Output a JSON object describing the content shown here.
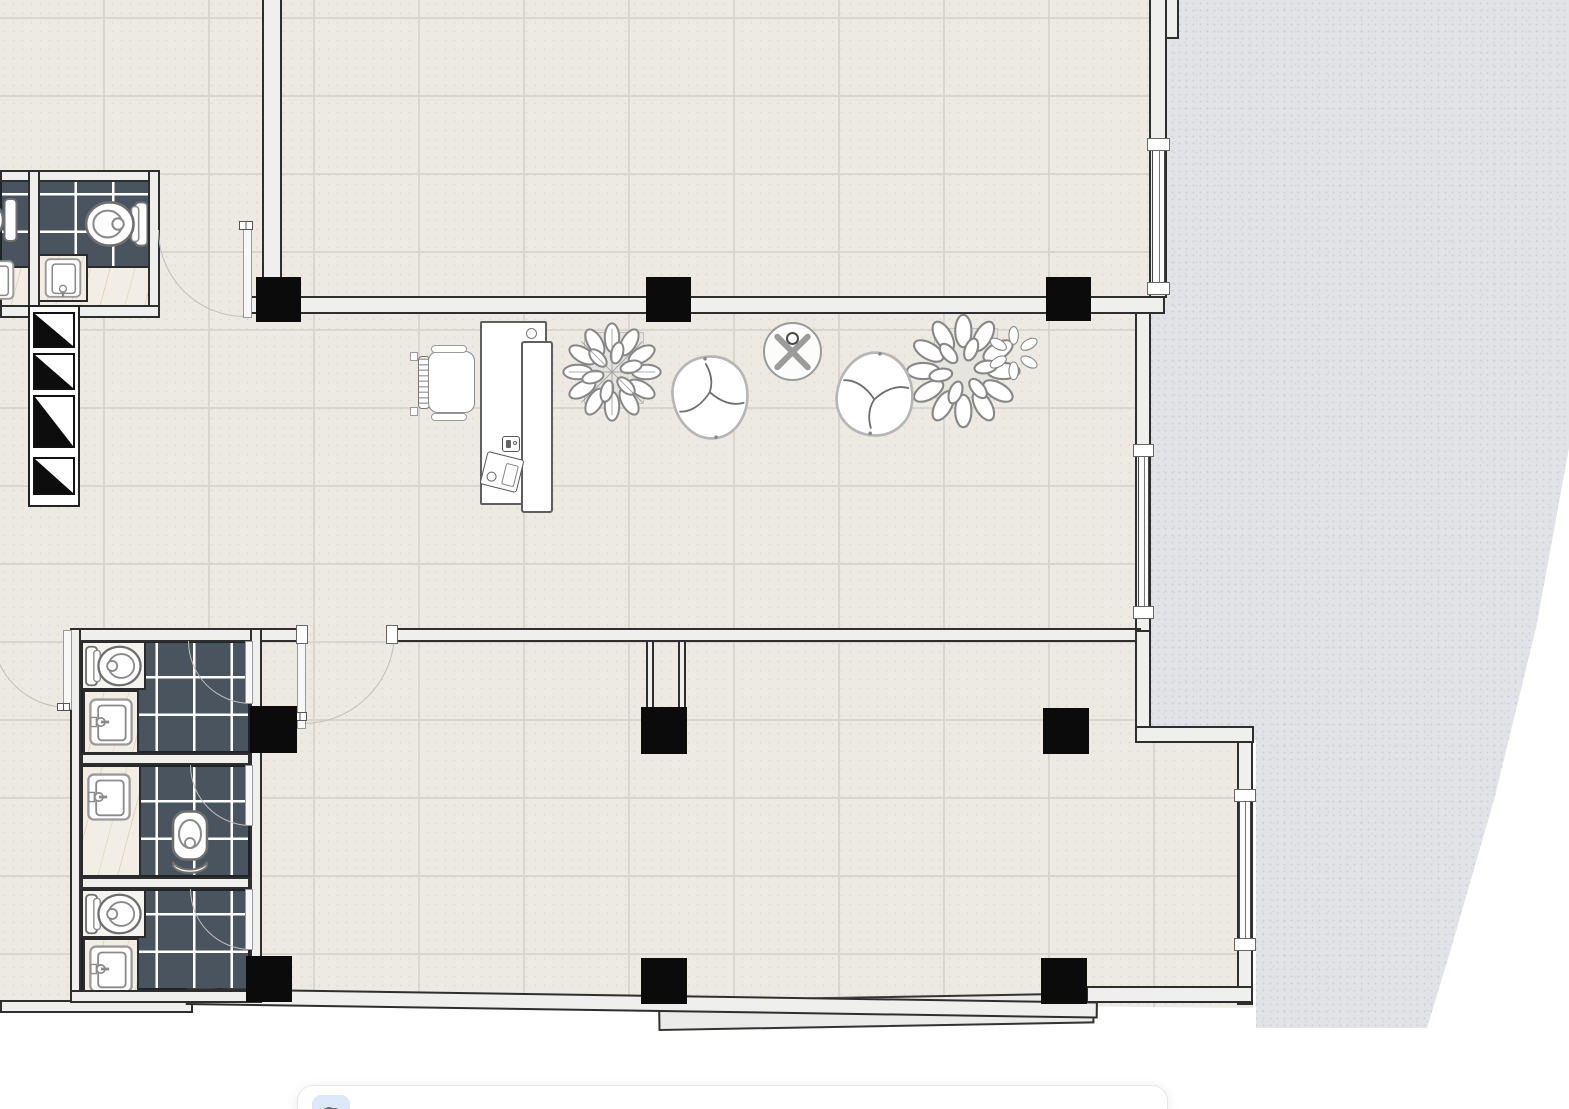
{
  "canvas": {
    "background": "#ffffff"
  },
  "palette": {
    "floor_tile": "#edeae3",
    "floor_grout": "#d9d6ce",
    "exterior_ground": "#e2e3e6",
    "wall_fill": "#efefed",
    "wall_line": "#2e2e2e",
    "column": "#0b0b0b",
    "bath_tile": "#4a545e",
    "bath_tile_grout": "#ffffff",
    "marble": "#f3eee5",
    "fixture_stroke": "#8a8a8a",
    "furniture_stroke": "#9c9c9c",
    "door_arc": "#bfbfbf",
    "toolbar_bg": "#ffffff",
    "toolbar_border": "#e7e7e7",
    "tool_fg": "#5f6368",
    "tool_selected_bg": "#dde9fb",
    "tool_selected_fg": "#2f6fe4"
  },
  "floorplan": {
    "rooms": [
      {
        "id": "upper-hall"
      },
      {
        "id": "lobby"
      },
      {
        "id": "lower-hall"
      },
      {
        "id": "wc-upper"
      },
      {
        "id": "wc-stall-1"
      },
      {
        "id": "wc-stall-2"
      },
      {
        "id": "wc-stall-3"
      },
      {
        "id": "stair-shaft"
      }
    ],
    "structure": {
      "columns": 9,
      "windows": 3,
      "doors": 6,
      "shaft_cells": 4
    },
    "fixtures": [
      {
        "type": "toilet",
        "room": "wc-upper"
      },
      {
        "type": "sink",
        "room": "wc-upper"
      },
      {
        "type": "toilet",
        "room": "wc-stall-1"
      },
      {
        "type": "sink",
        "room": "wc-stall-1"
      },
      {
        "type": "toilet",
        "room": "wc-stall-2"
      },
      {
        "type": "sink",
        "room": "wc-stall-2"
      },
      {
        "type": "toilet",
        "room": "wc-stall-3"
      },
      {
        "type": "sink",
        "room": "wc-stall-3"
      }
    ],
    "furniture": [
      "reception-desk",
      "office-chair",
      "lounge-chair-left",
      "lounge-chair-right",
      "round-side-table",
      "plant-small",
      "plant-large"
    ]
  },
  "toolbar": {
    "caret": "▾",
    "tools": [
      {
        "id": "select",
        "icon": "▶",
        "selected": true
      },
      {
        "id": "wall",
        "icon": "✎",
        "selected": false
      },
      {
        "id": "room",
        "icon": "▱",
        "selected": false
      },
      {
        "id": "door",
        "icon": "◠",
        "selected": false
      },
      {
        "id": "window",
        "icon": "▭",
        "selected": false
      },
      {
        "id": "column",
        "icon": "▪",
        "selected": false
      },
      {
        "id": "stairs",
        "icon": "≡",
        "selected": false
      },
      {
        "id": "text",
        "icon": "A",
        "selected": false
      },
      {
        "id": "measure",
        "icon": "↔",
        "selected": false
      },
      {
        "id": "furniture",
        "icon": "▤",
        "selected": false
      },
      {
        "id": "settings",
        "icon": "○",
        "selected": false
      }
    ]
  }
}
